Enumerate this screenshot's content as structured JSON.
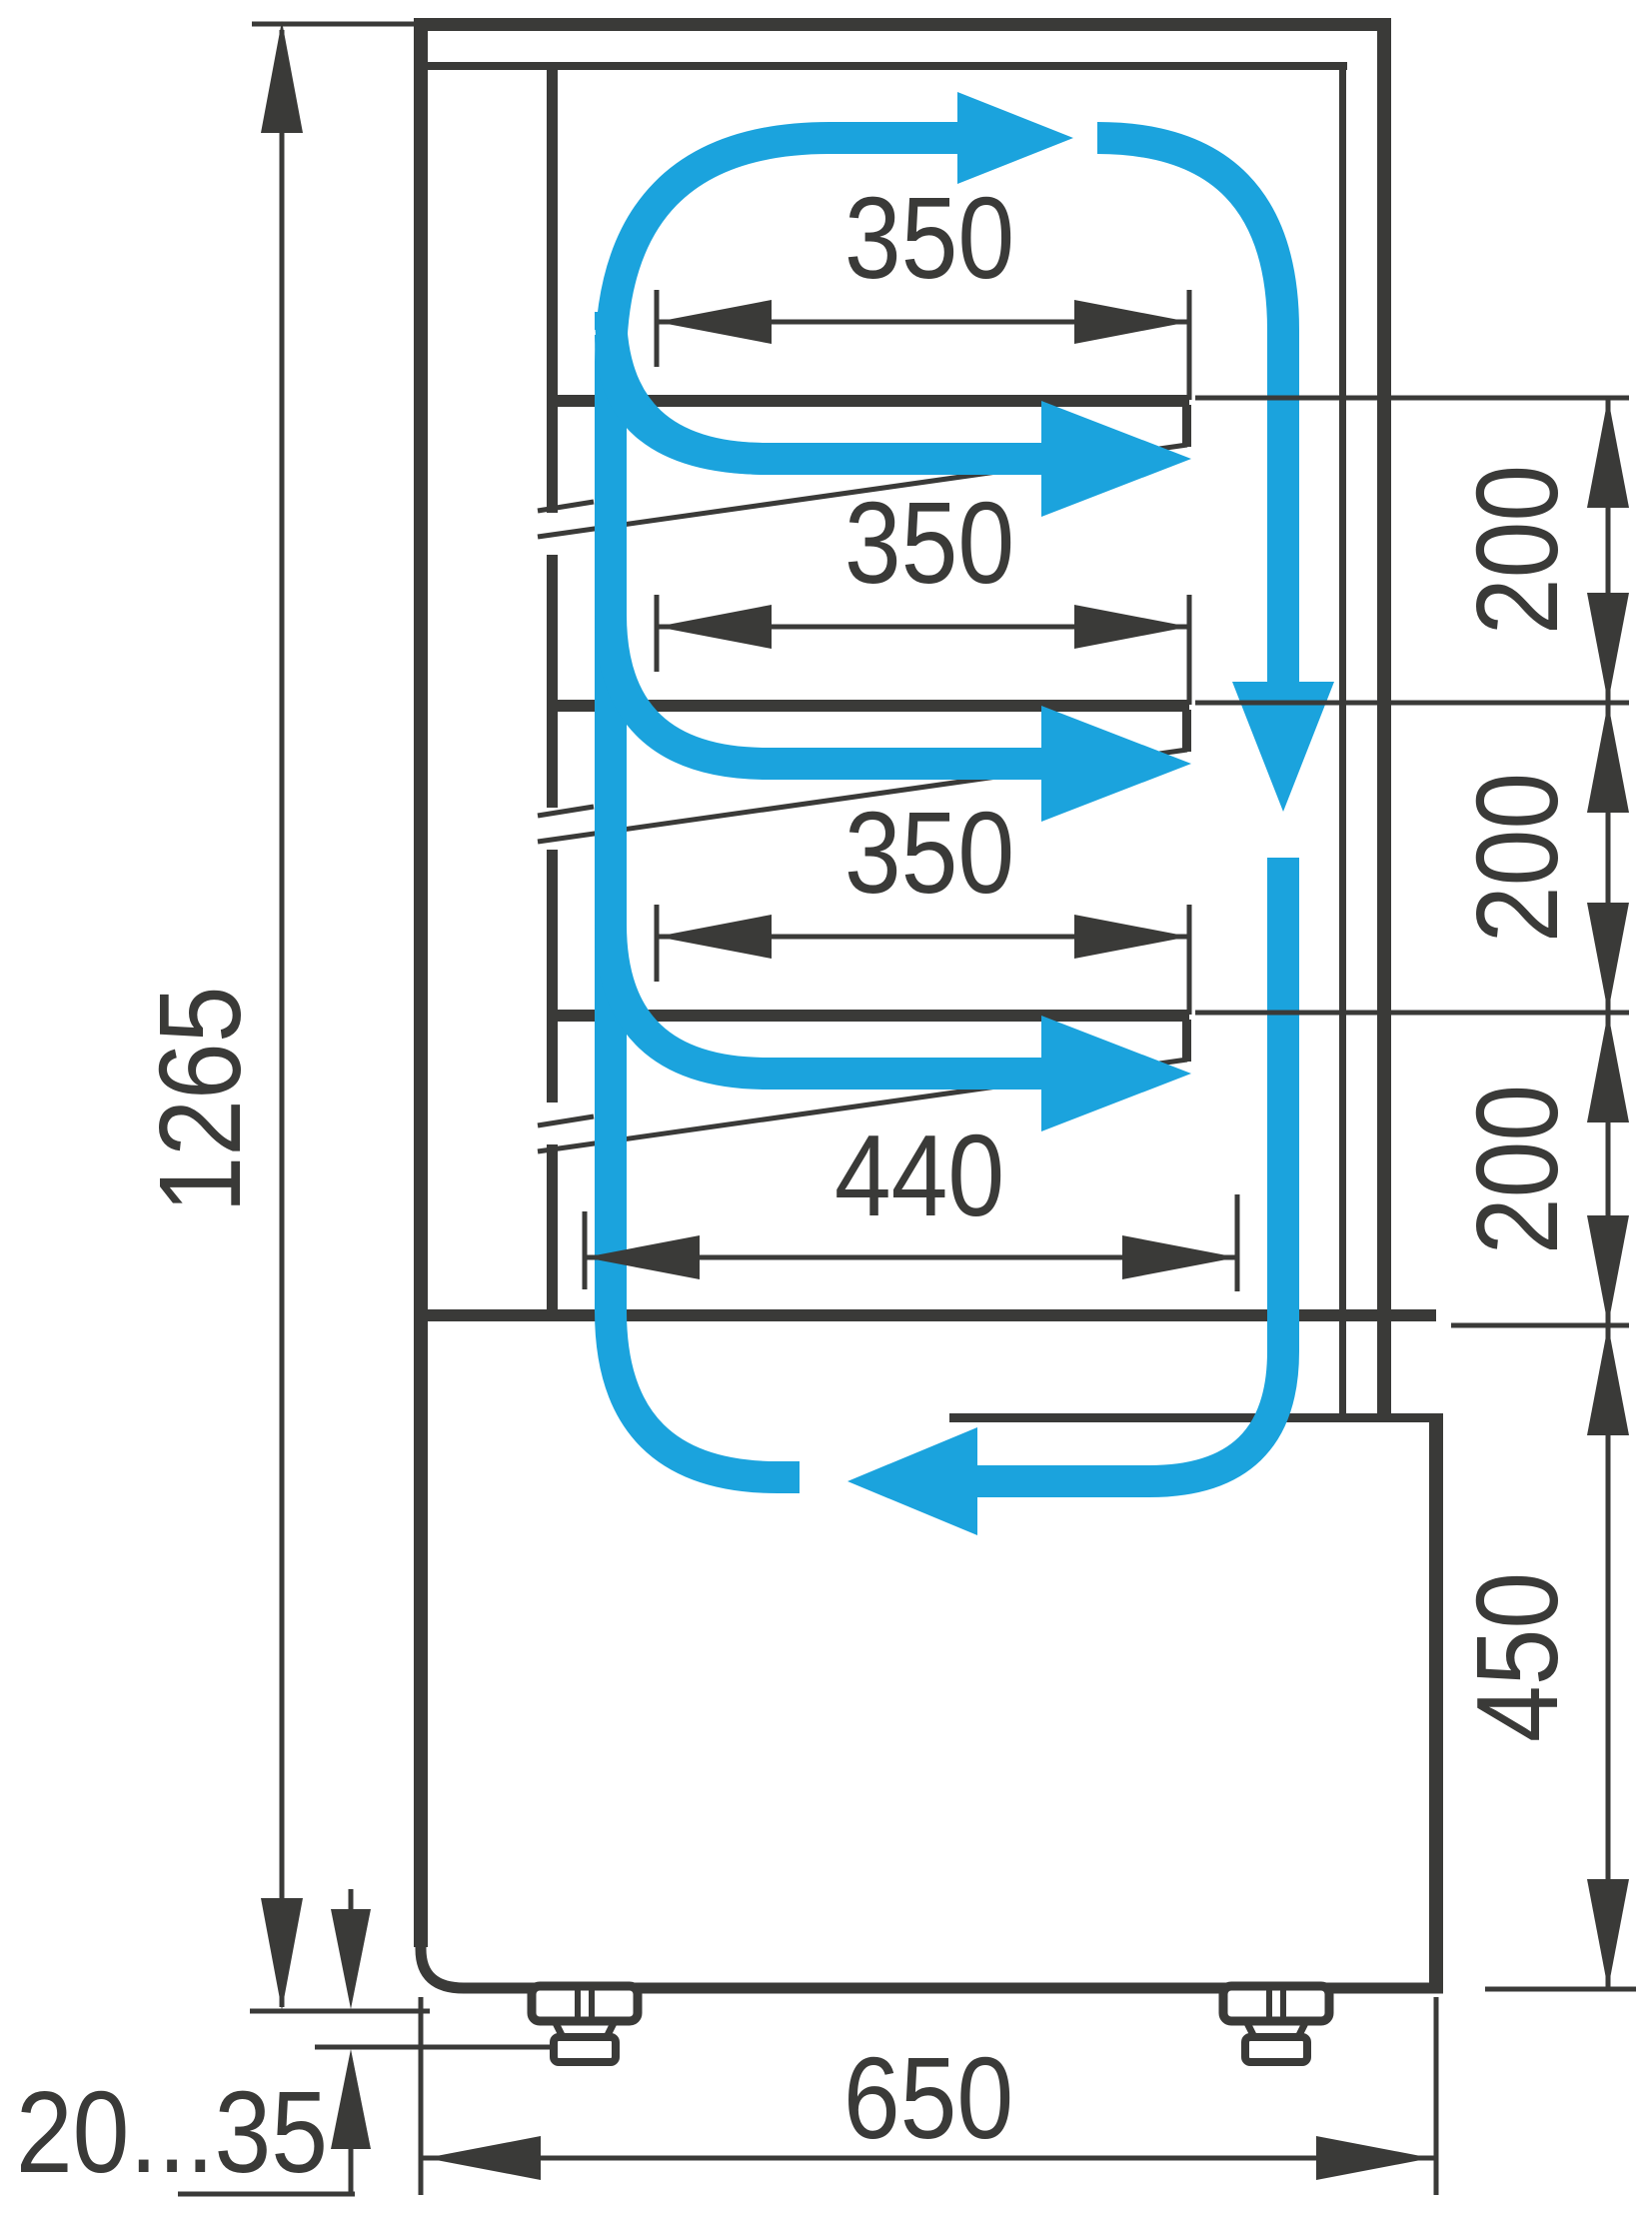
{
  "diagram": {
    "type": "technical-drawing",
    "subject": "refrigerated pastry display case - side section with airflow circulation",
    "units": "mm",
    "dimensions": {
      "shelf_depth_top": "350",
      "shelf_depth_middle": "350",
      "shelf_depth_lower": "350",
      "bottom_shelf_depth": "440",
      "shelf_gap_1": "200",
      "shelf_gap_2": "200",
      "shelf_gap_3": "200",
      "base_height": "450",
      "overall_height": "1265",
      "overall_depth": "650",
      "leg_adjustment_range": "20...35"
    },
    "colors": {
      "line": "#3a3a38",
      "airflow": "#1ba3dd",
      "background": "#ffffff"
    },
    "legend": {
      "airflow_meaning": "cold air circulation path",
      "arrow_icon": "airflow-arrow"
    }
  }
}
